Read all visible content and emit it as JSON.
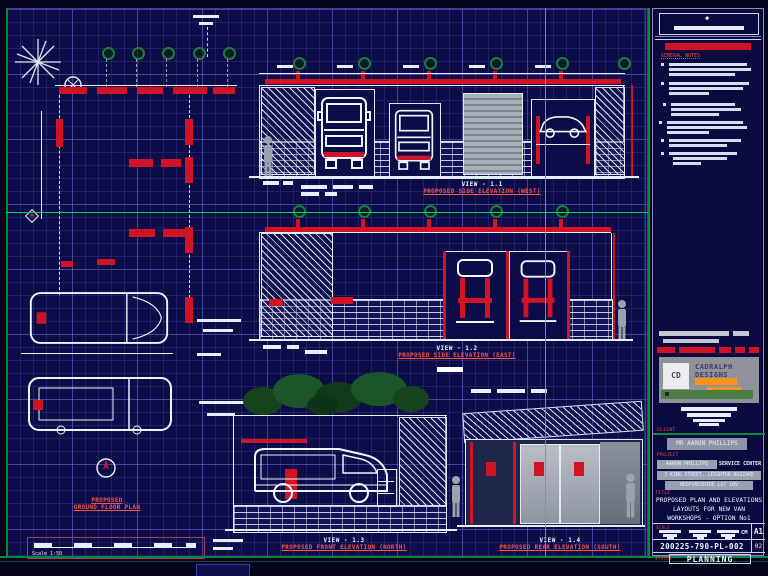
{
  "views": [
    {
      "label": "VIEW - 1.1",
      "title": "PROPOSED SIDE ELEVATION (WEST)"
    },
    {
      "label": "VIEW - 1.2",
      "title": "PROPOSED SIDE ELEVATION (EAST)"
    },
    {
      "label": "VIEW - 1.3",
      "title": "PROPOSED FRONT ELEVATION (NORTH)"
    },
    {
      "label": "VIEW - 1.4",
      "title": "PROPOSED REAR ELEVATION (SOUTH)"
    }
  ],
  "plan": {
    "title_line1": "PROPOSED",
    "title_line2": "GROUND FLOOR PLAN",
    "scale_text": "Scale 1:50"
  },
  "titleblock": {
    "notes_header": "GENERAL NOTES",
    "logo_monogram": "CD",
    "logo_name_line1": "CADRALPH",
    "logo_name_line2": "DESIGNS",
    "client_label": "CLIENT",
    "client_name": "MR AARON PHILLIPS",
    "project_label": "PROJECT",
    "project_line1a": "AARON PHILLIPS",
    "project_line1b": "SERVICE CENTER",
    "project_line2": "3 KING STREET, LEIGHTON BUZZARD",
    "project_line3": "BEDFORDSHIRE LU7 1BV",
    "title_label": "TITLE",
    "title_line1": "PROPOSED PLAN AND ELEVATIONS",
    "title_line2": "LAYOUTS FOR NEW VAN",
    "title_line3": "WORKSHOPS - OPTION No1",
    "scale_label": "SCALE",
    "units": "CM",
    "paper_size": "A1",
    "drawing_number": "200225-790-PL-002",
    "revision": "02",
    "status_label": "STATUS",
    "status": "PLANNING"
  },
  "colors": {
    "sheet_navy": "#0c0c49",
    "grid_blue": "#5050be",
    "accent_red": "#d11326",
    "green_border": "#0c8a3c",
    "crosshair_green": "#00e05e",
    "logo_orange": "#f7941d"
  }
}
